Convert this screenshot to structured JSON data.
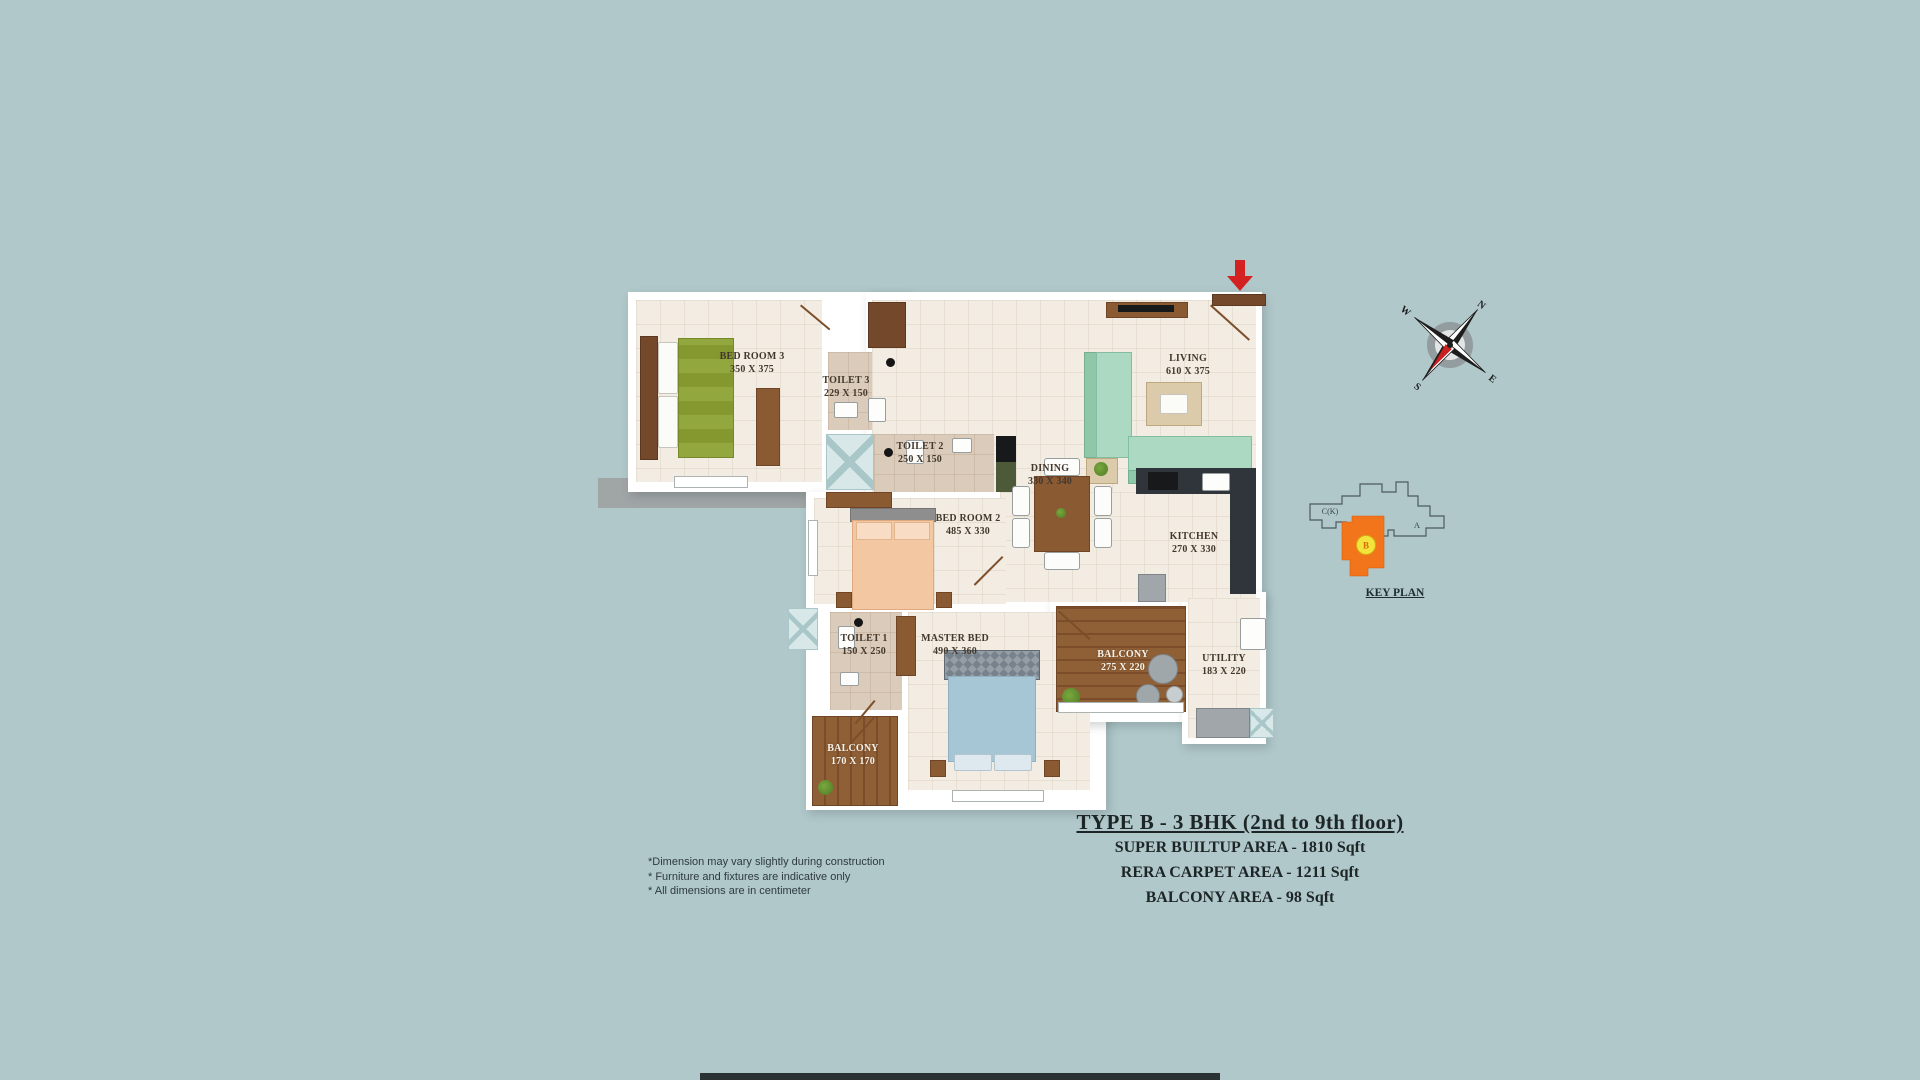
{
  "page": {
    "background_color": "#b0c8ca",
    "arrow_color": "#d42222"
  },
  "floor_plan": {
    "rooms": [
      {
        "name": "BED ROOM 3",
        "dims": "350 X 375"
      },
      {
        "name": "TOILET 3",
        "dims": "229 X 150"
      },
      {
        "name": "TOILET 2",
        "dims": "250 X 150"
      },
      {
        "name": "LIVING",
        "dims": "610 X 375"
      },
      {
        "name": "DINING",
        "dims": "330 X 340"
      },
      {
        "name": "BED ROOM 2",
        "dims": "485 X 330"
      },
      {
        "name": "KITCHEN",
        "dims": "270 X 330"
      },
      {
        "name": "TOILET 1",
        "dims": "150 X 250"
      },
      {
        "name": "MASTER BED",
        "dims": "490 X 360"
      },
      {
        "name": "BALCONY",
        "dims": "275 X 220"
      },
      {
        "name": "UTILITY",
        "dims": "183 X 220"
      },
      {
        "name": "BALCONY",
        "dims": "170 X 170"
      }
    ]
  },
  "compass": {
    "n": "N",
    "e": "E",
    "s": "S",
    "w": "W"
  },
  "key_plan": {
    "caption": "KEY PLAN",
    "unit_highlight": "B",
    "label_a": "A",
    "label_c": "C(K)",
    "highlight_color": "#f2751c",
    "marker_color": "#f5e33d"
  },
  "title_block": {
    "title": "TYPE B - 3 BHK (2nd to 9th floor)",
    "area_lines": [
      "SUPER BUILTUP AREA - 1810 Sqft",
      "RERA CARPET AREA - 1211 Sqft",
      "BALCONY AREA - 98 Sqft"
    ]
  },
  "disclaimers": [
    "*Dimension may vary slightly during construction",
    "* Furniture and fixtures are indicative only",
    "* All dimensions are in centimeter"
  ]
}
